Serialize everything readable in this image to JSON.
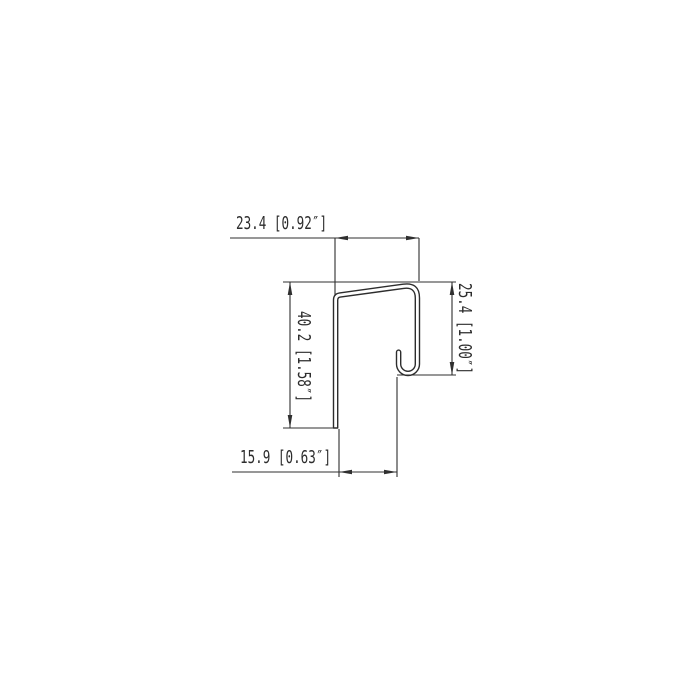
{
  "page": {
    "background_color": "#ffffff",
    "line_color": "#2f2f2f",
    "text_color": "#2d2d2d"
  },
  "drawing": {
    "kind": "technical-dimension-drawing",
    "subject": "j-channel-trim-profile-cross-section",
    "units": "mm [inches]",
    "dimensions": [
      {
        "id": "top-width",
        "label": "23.4 [0.92″]",
        "mm": 23.4,
        "inches": 0.92,
        "orientation": "horizontal",
        "position": "top"
      },
      {
        "id": "left-height",
        "label": "40.2 [1.58″]",
        "mm": 40.2,
        "inches": 1.58,
        "orientation": "vertical",
        "position": "left"
      },
      {
        "id": "right-height",
        "label": "25.4 [1.00″]",
        "mm": 25.4,
        "inches": 1.0,
        "orientation": "vertical",
        "position": "right"
      },
      {
        "id": "bottom-width",
        "label": "15.9 [0.63″]",
        "mm": 15.9,
        "inches": 0.63,
        "orientation": "horizontal",
        "position": "bottom"
      }
    ]
  }
}
